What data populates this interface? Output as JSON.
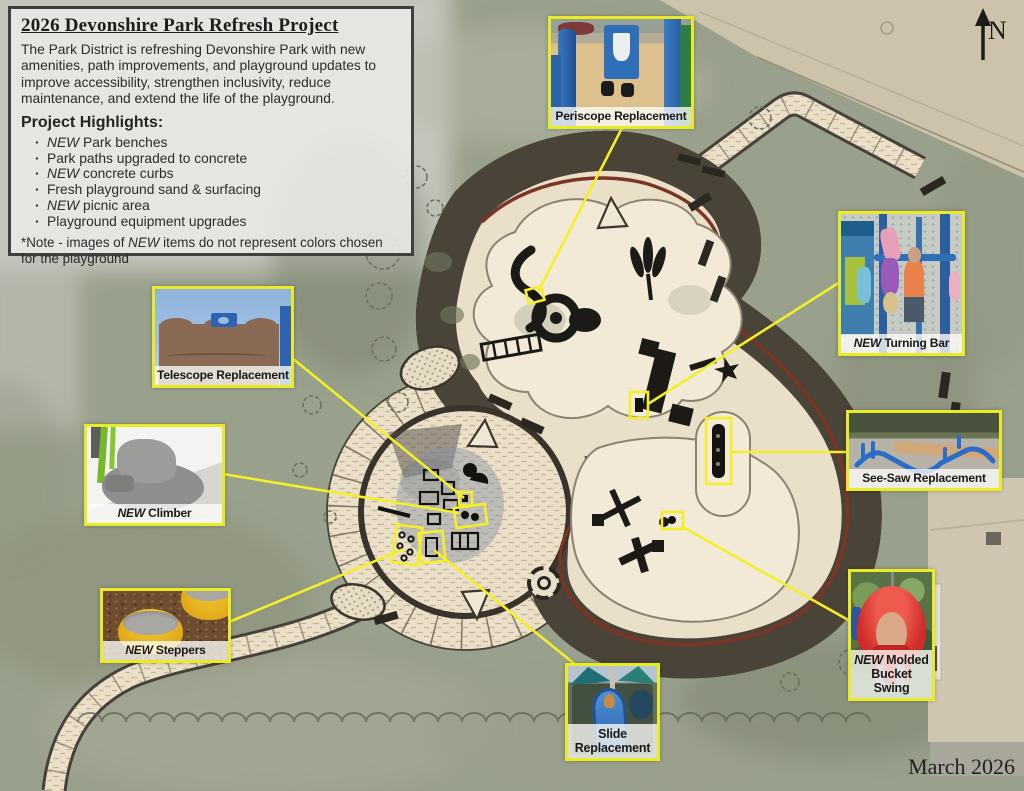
{
  "info_box": {
    "title": "2026 Devonshire Park Refresh Project",
    "description": "The Park District is refreshing Devonshire Park with new amenities, path improvements, and playground updates to improve accessibility, strengthen inclusivity, reduce maintenance, and extend the life of the playground.",
    "highlights_heading": "Project Highlights:",
    "highlights": [
      {
        "em": "NEW",
        "text": "Park benches"
      },
      {
        "em": "",
        "text": "Park paths upgraded to concrete"
      },
      {
        "em": "NEW",
        "text": "concrete curbs"
      },
      {
        "em": "",
        "text": "Fresh playground sand & surfacing"
      },
      {
        "em": "NEW",
        "text": "picnic area"
      },
      {
        "em": "",
        "text": "Playground equipment upgrades"
      }
    ],
    "note_pre": "*Note - images of ",
    "note_em": "NEW",
    "note_post": " items do not represent colors chosen for the playground"
  },
  "callouts": {
    "periscope": {
      "em": "",
      "label": "Periscope Replacement"
    },
    "telescope": {
      "em": "",
      "label": "Telescope Replacement"
    },
    "climber": {
      "em": "NEW",
      "label": "Climber"
    },
    "steppers": {
      "em": "NEW",
      "label": "Steppers"
    },
    "slide": {
      "em": "",
      "label": "Slide Replacement"
    },
    "turning_bar": {
      "em": "NEW",
      "label": "Turning Bar"
    },
    "see_saw": {
      "em": "",
      "label": "See-Saw Replacement"
    },
    "bucket_swing": {
      "em": "NEW",
      "label": "Molded Bucket Swing"
    }
  },
  "compass": {
    "label": "N"
  },
  "date_label": "March 2026",
  "colors": {
    "callout_border": "#e9ec25",
    "connector_line": "#f3ef2a",
    "playground_sand": "#eadfc9",
    "curb_dark": "#3a332b",
    "curb_red": "#7a3526",
    "grass": "#99a08b"
  }
}
